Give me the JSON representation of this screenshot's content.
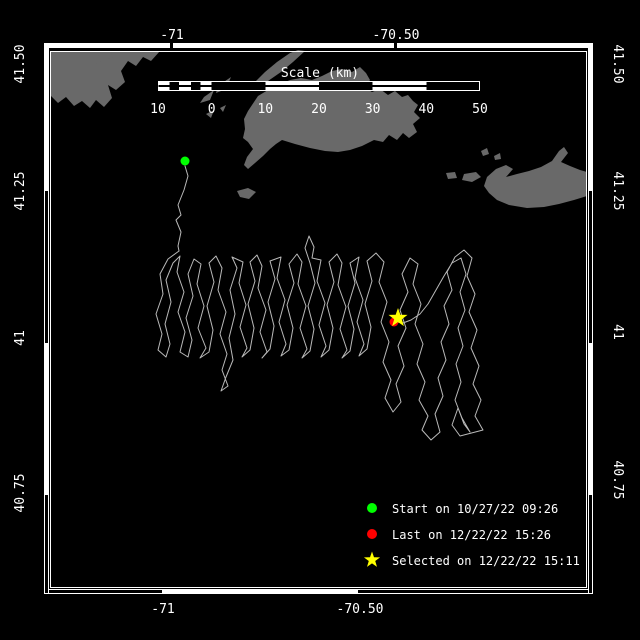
{
  "colors": {
    "background": "#000000",
    "land": "#696969",
    "track": "#b9b9b9",
    "frame": "#ffffff",
    "text": "#ffffff",
    "start_marker": "#00ff00",
    "last_marker": "#ff0000",
    "selected_marker": "#ffff00"
  },
  "axes": {
    "top": [
      "-71",
      "-70.50"
    ],
    "bottom": [
      "-71",
      "-70.50"
    ],
    "left": [
      "41.50",
      "41.25",
      "41",
      "40.75"
    ],
    "right": [
      "41.50",
      "41.25",
      "41",
      "40.75"
    ]
  },
  "scale_bar": {
    "title": "Scale (km)",
    "tick_labels": [
      "10",
      "0",
      "10",
      "20",
      "30",
      "40",
      "50"
    ]
  },
  "legend": {
    "items": [
      {
        "marker": "circle",
        "color": "#00ff00",
        "label": "Start on 10/27/22 09:26"
      },
      {
        "marker": "circle",
        "color": "#ff0000",
        "label": "Last on 12/22/22 15:26"
      },
      {
        "marker": "star",
        "color": "#ffff00",
        "label": "Selected on 12/22/22 15:11"
      }
    ]
  },
  "markers": {
    "start": {
      "x": 185,
      "y": 161
    },
    "last": {
      "x": 394,
      "y": 322
    },
    "selected": {
      "x": 398,
      "y": 318
    }
  },
  "geometry": {
    "star": "M0,-10 L2.35,-3.24 L9.51,-3.09 L3.8,1.24 L5.88,8.09 L0,4 L-5.88,8.09 L-3.8,1.24 L-9.51,-3.09 L-2.35,-3.24 Z",
    "land": {
      "mainland": "M50,51 L160,51 L151,61 L143,57 L136,66 L128,61 L121,71 L125,82 L116,90 L108,85 L112,98 L104,107 L96,100 L90,108 L82,101 L74,106 L66,97 L58,103 L50,95 Z",
      "bay_islets": "M92,58 L100,55 L103,61 L95,64 Z M106,54 L111,52 L113,58 L108,59 Z",
      "elizabeth_islands": "M255,82 L265,72 L277,62 L290,53 L298,50 L305,51 L293,62 L281,72 L268,81 L258,88 Z M218,86 L231,77 L226,89 L216,93 Z M204,97 L214,90 L210,100 L200,103 Z M206,114 L214,110 L211,118 Z M220,108 L226,105 L223,112 Z",
      "marthas_vineyard": "M250,108 L258,96 L268,90 L278,85 L290,80 L301,78 L312,80 L322,76 L332,71 L342,69 L352,72 L360,67 L366,73 L370,80 L365,88 L372,92 L380,89 L388,95 L395,91 L402,97 L408,95 L413,101 L418,105 L414,112 L420,118 L413,124 L417,132 L409,138 L403,133 L397,140 L389,135 L383,142 L374,140 L362,146 L350,150 L338,152 L325,151 L310,148 L295,144 L282,140 L276,144 L270,149 L263,156 L255,163 L248,169 L244,165 L247,157 L253,149 L248,142 L243,138 L245,129 L244,119 L248,111 Z",
      "nomans_land": "M237,191 L248,188 L256,192 L249,199 L240,197 Z",
      "nantucket": "M487,177 L496,169 L506,165 L513,169 L506,177 L517,174 L529,171 L541,167 L552,161 L559,151 L564,147 L568,153 L561,162 L570,166 L580,170 L587,172 L587,196 L574,200 L559,204 L544,207 L527,208 L509,205 L497,200 L489,193 L484,186 Z",
      "small_islands": "M464,174 L476,172 L481,177 L472,182 L462,180 Z M446,173 L455,172 L457,178 L448,179 Z M481,151 L487,148 L489,154 L483,156 Z M494,156 L500,153 L501,159 L495,160 Z"
    },
    "track": {
      "approach": "M185,166 L188,176 L184,190 L178,205 L181,215 L176,220 L181,232 L178,246 L179,251",
      "main": "M179,251 L168,259 L160,274 L163,294 L156,314 L162,334 L158,350 L166,357 L170,344 L165,324 L171,302 L166,280 L173,263 L180,256 L177,272 L184,292 L178,312 L185,332 L180,352 L188,357 L192,340 L186,318 L193,296 L188,274 L194,259 L201,264 L197,284 L204,306 L198,328 L206,348 L200,358 L209,352 L213,330 L207,306 L214,282 L209,263 L216,256 L222,268 L218,290 L226,312 L220,334 L227,354 L222,370 L228,386 L221,391 L226,377 L233,360 L229,338 L235,314 L230,290 L237,268 L232,257 L243,262 L239,283 L246,305 L240,327 L247,348 L242,357 L250,350 L254,328 L248,304 L255,281 L250,262 L257,255 L262,266 L258,288 L266,310 L260,332 L267,352 L262,358 L270,349 L274,326 L268,302 L275,279 L270,261 L281,257 L277,278 L285,300 L279,322 L286,344 L281,356 L289,350 L293,328 L287,305 L294,283 L289,264 L297,254 L302,262 L298,284 L306,306 L300,328 L307,349 L302,358 L310,351 L314,329 L308,306 L315,283 L310,263 L305,248 L309,236 L314,247 L312,258 L321,260 L317,281 L325,303 L319,325 L326,346 L321,357 L329,350 L333,328 L327,305 L334,282 L329,262 L337,254 L342,263 L338,285 L346,307 L340,329 L347,350 L342,358 L350,351 L354,329 L348,306 L355,283 L350,263 L359,257 L355,278 L363,300 L357,322 L364,344 L359,356 L367,349 L371,327 L365,304 L372,281 L367,261 L376,253 L384,262 L379,282 L387,302 L381,322 L389,342 L383,362 L391,380 L385,398 L393,412 L401,402 L396,384 L404,366 L398,346 L406,328 L400,310 L408,292 L402,274 L410,258 L418,264 L413,284 L421,304 L415,324 L423,344 L417,364 L425,382 L419,400 L428,416 L422,430 L431,440 L440,432 L435,414 L443,396 L438,378 L446,360 L441,342 L449,324 L444,306 L452,290 L447,272 L455,257 L464,250 L472,258 L467,276 L475,294 L469,312 L477,330 L471,348 L479,366 L473,384 L481,400 L475,416 L483,430 L460,436 L452,425 L458,408 L464,424 L470,432 L462,418 L455,400 L461,382 L456,364 L463,346 L458,328 L465,310 L460,292 L466,274 L461,258 L452,263 L444,276 L436,290 L428,304 L420,314 L411,320 L403,323 L396,322"
    }
  }
}
